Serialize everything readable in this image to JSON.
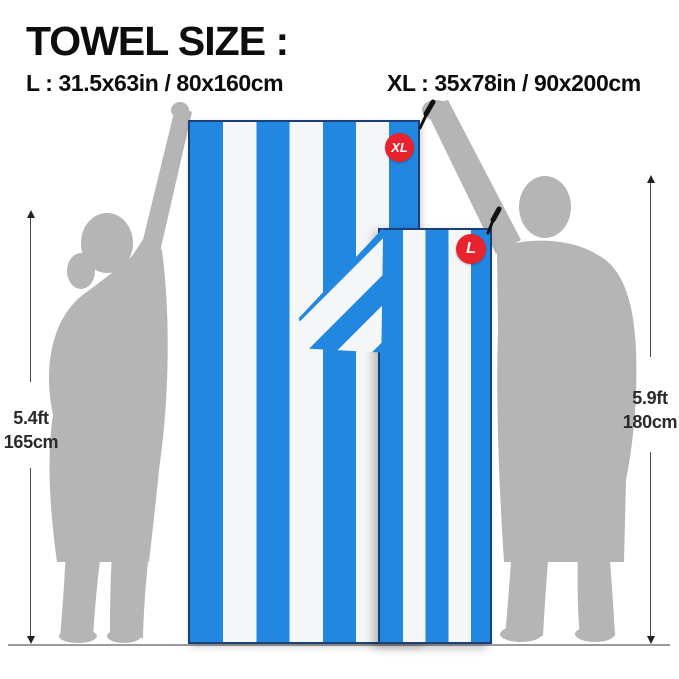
{
  "title": "TOWEL SIZE :",
  "sizes": {
    "l_label": "L : 31.5x63in / 80x160cm",
    "xl_label": "XL : 35x78in / 90x200cm"
  },
  "badges": {
    "xl": "XL",
    "l": "L"
  },
  "measurements": {
    "left": {
      "ft": "5.4ft",
      "cm": "165cm"
    },
    "right": {
      "ft": "5.9ft",
      "cm": "180cm"
    }
  },
  "colors": {
    "towel_blue": "#2187e1",
    "stripe_white": "#f4f6f8",
    "badge_red": "#e8232e",
    "silhouette_gray": "#b5b5b5",
    "edge_navy": "#1d3f77",
    "ground_gray": "#9b9b9b",
    "text_black": "#0d0d0d"
  }
}
